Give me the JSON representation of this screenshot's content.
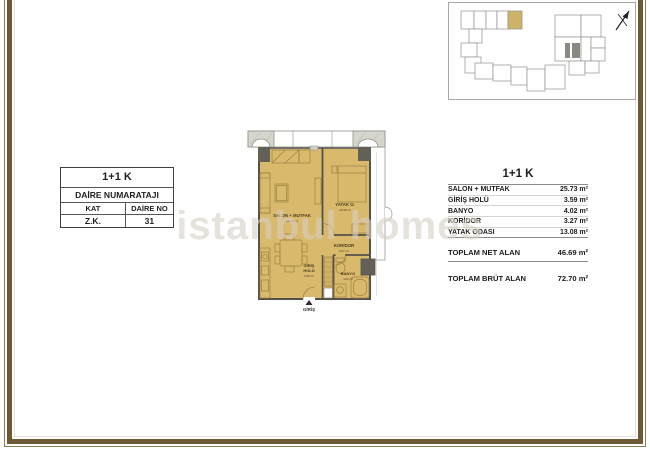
{
  "colors": {
    "frame_brown": "#6d5935",
    "room_tan": "#d9ba6c",
    "keyplan_highlight": "#cfb269",
    "core_gray": "#8a8a84",
    "column_gray": "#636058"
  },
  "unit_table": {
    "title": "1+1 K",
    "subtitle": "DAİRE NUMARATAJI",
    "kat_header": "KAT",
    "daire_header": "DAİRE NO",
    "kat_value": "Z.K.",
    "daire_value": "31"
  },
  "area_table": {
    "title": "1+1 K",
    "rows": [
      {
        "label": "SALON + MUTFAK",
        "value": "25.73 m²"
      },
      {
        "label": "GİRİŞ HOLÜ",
        "value": "3.59 m²"
      },
      {
        "label": "BANYO",
        "value": "4.02 m²"
      },
      {
        "label": "KORİDOR",
        "value": "3.27 m²"
      },
      {
        "label": "YATAK ODASI",
        "value": "13.08 m²"
      }
    ],
    "total_net": {
      "label": "TOPLAM NET ALAN",
      "value": "46.69 m²"
    },
    "total_brut": {
      "label": "TOPLAM BRÜT ALAN",
      "value": "72.70 m²"
    }
  },
  "floor_plan": {
    "salon": {
      "name": "SALON + MUTFAK",
      "area": "25.73 m²"
    },
    "bedroom": {
      "name": "YATAK O.",
      "area": "13.08 m²"
    },
    "corridor": {
      "name": "KORİDOR",
      "area": "3.27 m²"
    },
    "entry_hall": {
      "name_line1": "GİRİŞ",
      "name_line2": "HOLÜ",
      "area": "3.59 m²"
    },
    "bathroom": {
      "name": "BANYO",
      "area": "4.02 m²"
    },
    "entrance_label": "GİRİŞ"
  },
  "watermark": "istanbul homes"
}
